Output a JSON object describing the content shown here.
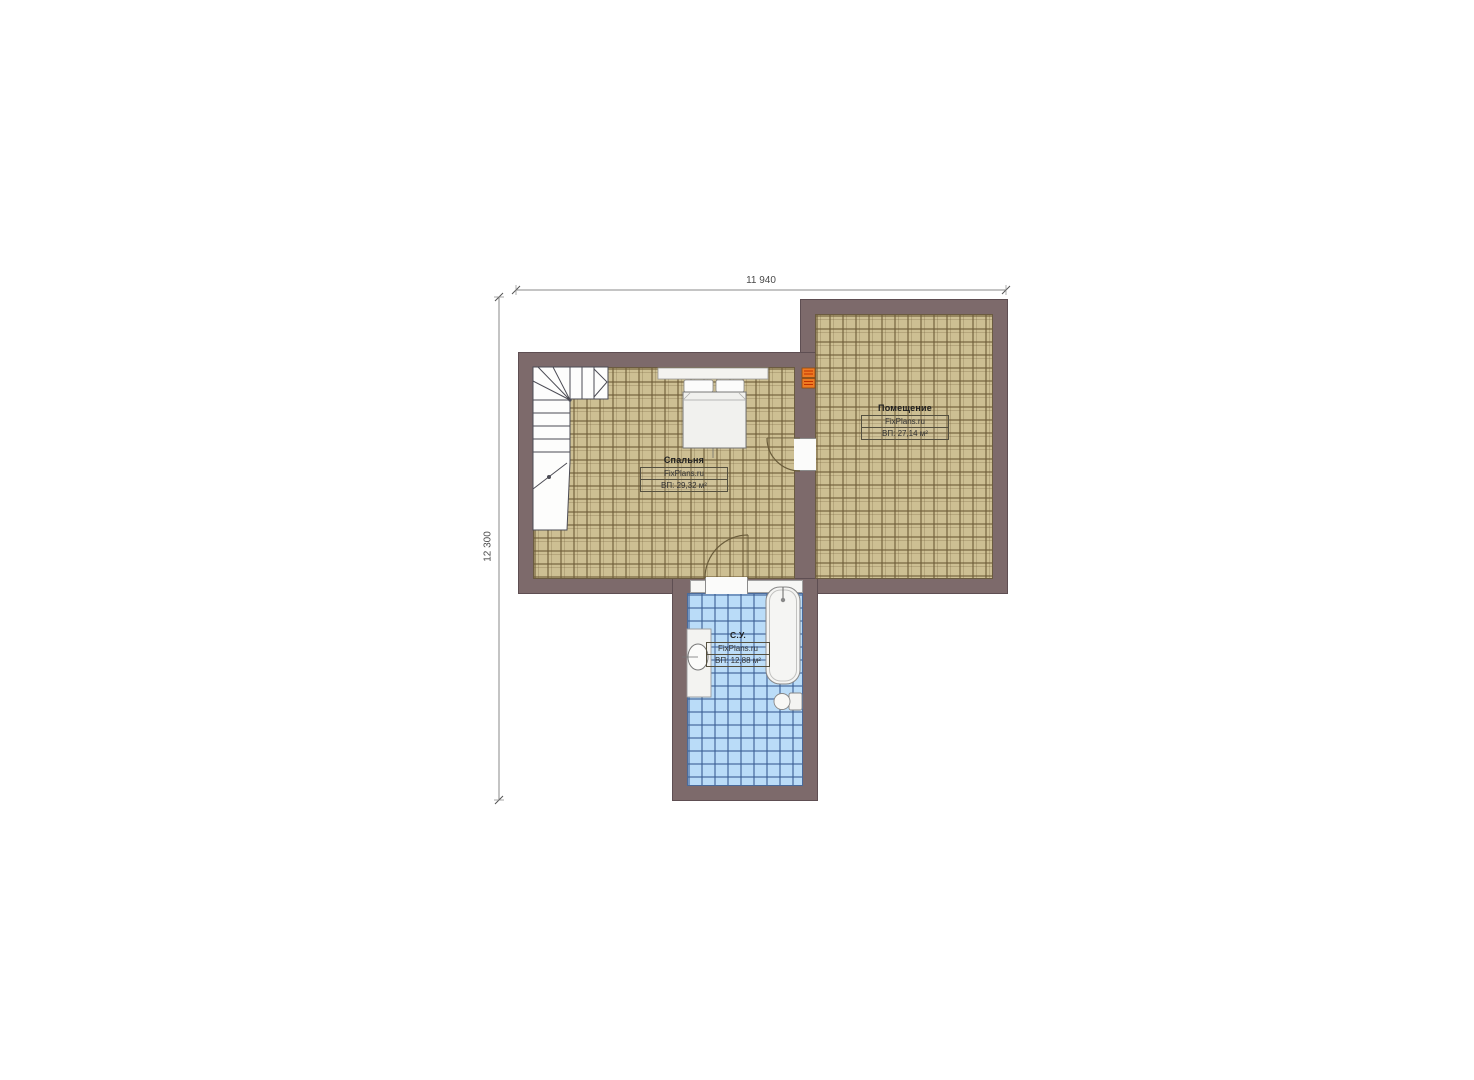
{
  "plan": {
    "title": "floor plan (second level)",
    "dimensions": {
      "width_label": "11 940",
      "height_label": "12 300"
    },
    "rooms": {
      "bedroom": {
        "name": "Спальня",
        "watermark": "FixPlans.ru",
        "area": "ВП: 29,32 м²"
      },
      "main": {
        "name": "Помещение",
        "watermark": "FixPlans.ru",
        "area": "ВП: 27,14 м²"
      },
      "bathroom": {
        "name": "С.У.",
        "watermark": "FixPlans.ru",
        "area": "ВП: 12,88 м²"
      }
    },
    "colors": {
      "wall": "#7d6a6b",
      "floor_tile": "#cdbf93",
      "floor_tile_grout": "#8d7c5c",
      "bath_tile": "#badcf8",
      "bath_tile_grout": "#5a7fb4",
      "fixtures": "#f2f2ef",
      "radiator": "#ee7a22",
      "dimension_line": "#777777"
    }
  }
}
